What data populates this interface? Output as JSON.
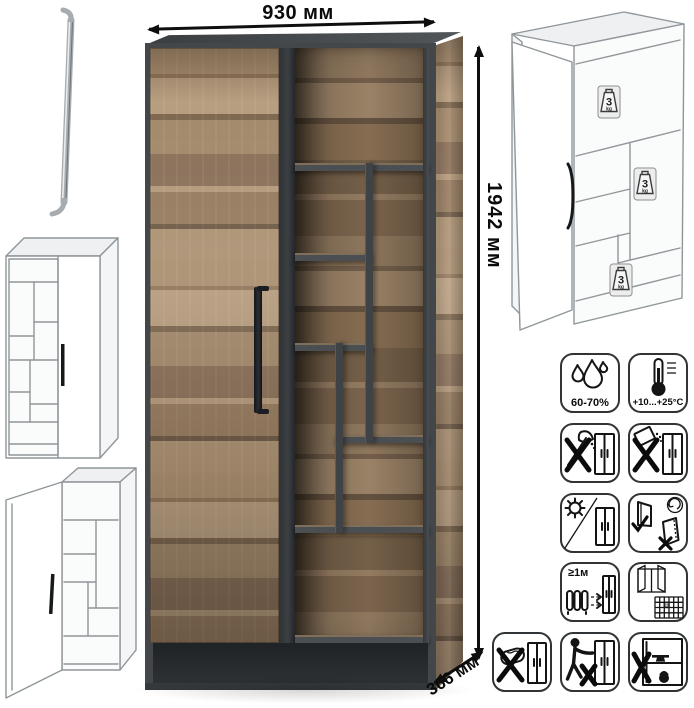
{
  "dimensions": {
    "width": "930 мм",
    "height": "1942 мм",
    "depth": "366 мм"
  },
  "shelf_load": {
    "value": "3",
    "unit": "kg"
  },
  "care": {
    "humidity": "60-70%",
    "temperature": "+10...+25°C",
    "heat_distance": "≥1м",
    "vent_cell": "21"
  },
  "colors": {
    "wood": "#a1876a",
    "frame": "#43474a",
    "handle": "#1b1e22",
    "arrow": "#0e0e0e",
    "sketch_stroke": "#8f969a"
  },
  "icons_semantics": [
    "humidity-60-70",
    "temperature-range",
    "no-sharp-tools",
    "no-abrasive-powder",
    "no-direct-sunlight",
    "door-adjustment-correct-wrong",
    "keep-1m-from-heaters",
    "ventilate-room",
    "no-wet-cleaning",
    "no-climbing-or-pulling",
    "no-overloading"
  ]
}
